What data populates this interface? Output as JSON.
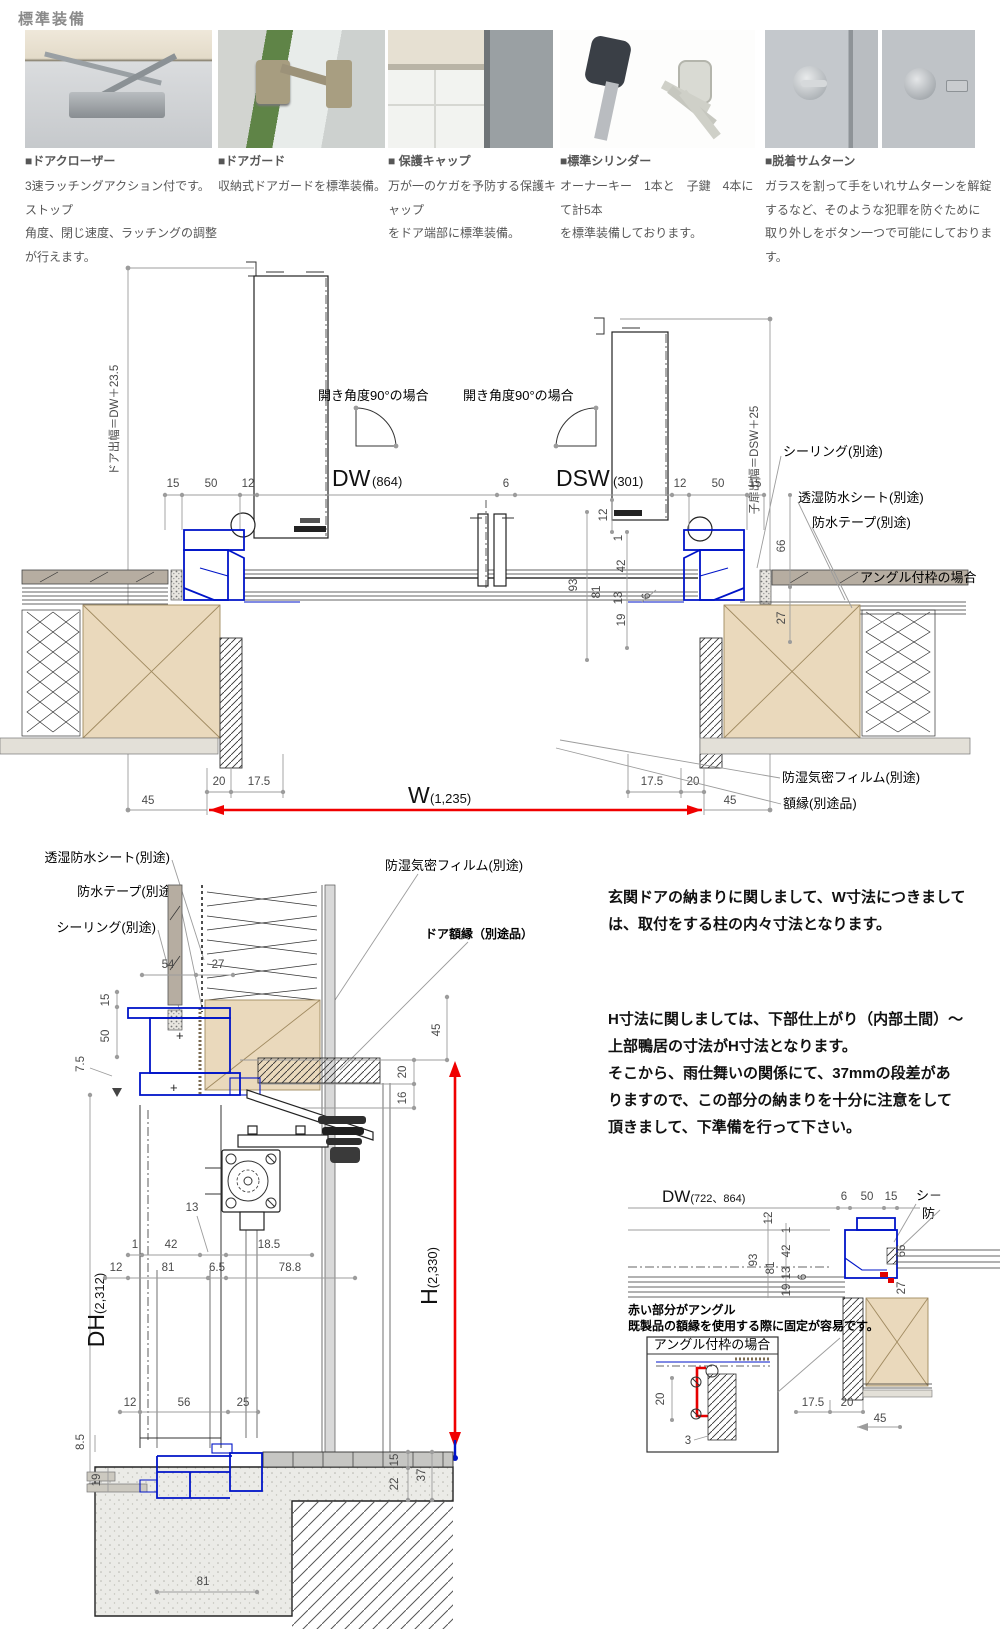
{
  "header": {
    "title": "標準装備"
  },
  "features": [
    {
      "name": "■ドアクローザー",
      "l1": "3速ラッチングアクション付です。ストップ",
      "l2": "角度、閉じ速度、ラッチングの調整が行えます。",
      "l3": ""
    },
    {
      "name": "■ドアガード",
      "l1": "収納式ドアガードを標準装備。",
      "l2": "",
      "l3": ""
    },
    {
      "name": "■ 保護キャップ",
      "l1": "万が一のケガを予防する保護キャップ",
      "l2": "をドア端部に標準装備。",
      "l3": ""
    },
    {
      "name": "■標準シリンダー",
      "l1": "オーナーキー　1本と　子鍵　4本にて計5本",
      "l2": "を標準装備しております。",
      "l3": ""
    },
    {
      "name": "■脱着サムターン",
      "l1": "ガラスを割って手をいれサムターンを解錠",
      "l2": "するなど、そのような犯罪を防ぐために",
      "l3": "取り外しをボタン一つで可能にしております。"
    }
  ],
  "plan": {
    "door_exit": "ドア出幅＝DW＋23.5",
    "child_exit": "子扉出幅＝DSW＋25",
    "open_angle1": "開き角度90°の場合",
    "open_angle2": "開き角度90°の場合",
    "dw": "DW",
    "dw_v": "(864)",
    "dsw": "DSW",
    "dsw_v": "(301)",
    "w": "W",
    "w_v": "(1,235)",
    "sealing": "シーリング(別途)",
    "sheet": "透湿防水シート(別途)",
    "tape": "防水テープ(別途)",
    "angle_frame": "アングル付枠の場合",
    "film": "防湿気密フィルム(別途)",
    "casing": "額縁(別途品)"
  },
  "vert": {
    "sheet": "透湿防水シート(別途)",
    "tape": "防水テープ(別途)",
    "sealing": "シーリング(別途)",
    "film": "防湿気密フィルム(別途)",
    "door_casing": "ドア額縁（別途品）",
    "dh": "DH",
    "dh_v": "(2,312)",
    "h": "H",
    "h_v": "(2,330)"
  },
  "notes": {
    "l1": "玄関ドアの納まりに関しまして、W寸法につきまして",
    "l2": "は、取付をする柱の内々寸法となります。",
    "l3": "H寸法に関しましては、下部仕上がり（内部土間）～",
    "l4": "上部鴨居の寸法がH寸法となります。",
    "l5": "そこから、雨仕舞いの関係にて、37mmの段差があ",
    "l6": "りますので、この部分の納まりを十分に注意をして",
    "l7": "頂きまして、下準備を行って下さい。"
  },
  "detail": {
    "dw": "DW",
    "dw_v": "(722、864)",
    "note1": "赤い部分がアングル",
    "note2": "既製品の額縁を使用する際に固定が容易です。",
    "box_title": "アングル付枠の場合",
    "trunc1": "シ－",
    "trunc2": "防"
  },
  "dims": {
    "d1": "1",
    "d3": "3",
    "d6": "6",
    "d6_5": "6.5",
    "d7_5": "7.5",
    "d8_5": "8.5",
    "d12": "12",
    "d13": "13",
    "d15": "15",
    "d16": "16",
    "d17_5": "17.5",
    "d18_5": "18.5",
    "d19": "19",
    "d20": "20",
    "d22": "22",
    "d25": "25",
    "d27": "27",
    "d37": "37",
    "d42": "42",
    "d45": "45",
    "d50": "50",
    "d54": "54",
    "d56": "56",
    "d66": "66",
    "d78_8": "78.8",
    "d81": "81",
    "d93": "93"
  },
  "colors": {
    "accent_blue": "#0014c8",
    "accent_red": "#ff0000",
    "wood": "#ead9bc",
    "board_gray": "#b6ada1"
  }
}
